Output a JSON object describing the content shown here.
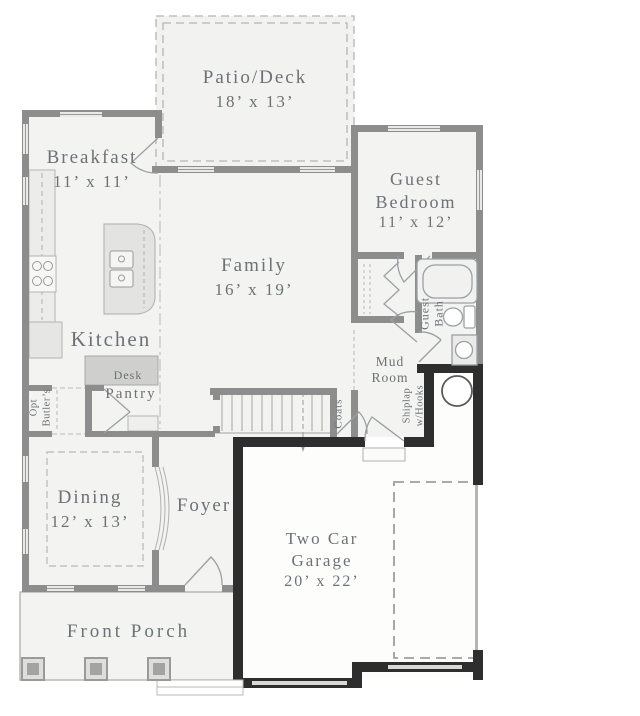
{
  "colors": {
    "wall": "#8d8d8d",
    "garage_wall": "#2e2e2e",
    "room_fill": "#f3f3f1",
    "label_text": "#6c7276"
  },
  "rooms": {
    "patio": {
      "line1": "Patio/Deck",
      "dims": "18’ x 13’"
    },
    "breakfast": {
      "line1": "Breakfast",
      "dims": "11’ x 11’"
    },
    "family": {
      "line1": "Family",
      "dims": "16’ x 19’"
    },
    "guest_bedroom": {
      "line1": "Guest",
      "line2": "Bedroom",
      "dims": "11’ x 12’"
    },
    "kitchen": {
      "line1": "Kitchen"
    },
    "dining": {
      "line1": "Dining",
      "dims": "12’ x 13’"
    },
    "foyer": {
      "line1": "Foyer"
    },
    "garage": {
      "line1": "Two Car",
      "line2": "Garage",
      "dims": "20’ x 22’"
    },
    "front_porch": {
      "line1": "Front Porch"
    },
    "mud_room": {
      "line1": "Mud",
      "line2": "Room"
    },
    "guest_bath": {
      "line1": "Guest",
      "line2": "Bath"
    },
    "pantry": {
      "line1": "Pantry"
    },
    "desk": {
      "line1": "Desk"
    },
    "coats": {
      "line1": "Coats"
    },
    "shiplap": {
      "line1": "Shiplap",
      "line2": "w/Hooks"
    },
    "opt_butlers": {
      "line1": "Opt",
      "line2": "Butler’s"
    }
  }
}
